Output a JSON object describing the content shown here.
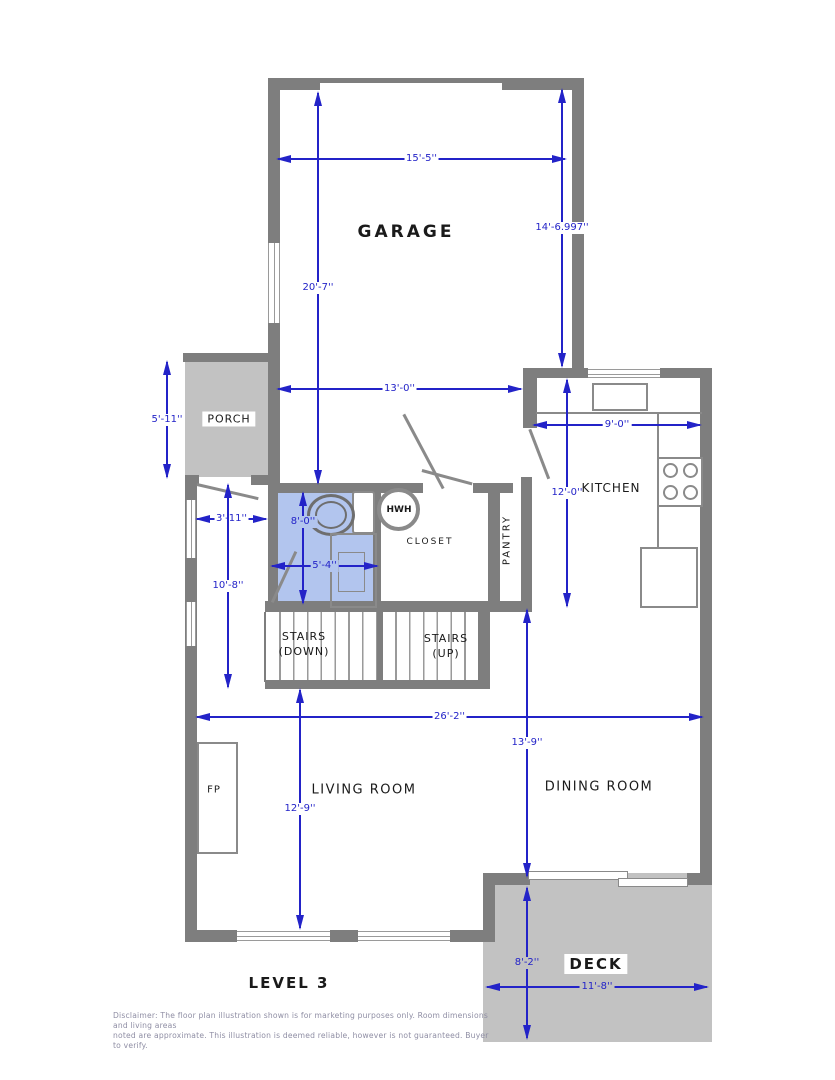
{
  "title": "Level 3 floor plan",
  "level_label": "LEVEL 3",
  "colors": {
    "wall": "#7e7e7e",
    "exterior_gray": "#c2c2c2",
    "bathroom_blue": "#b2c5ee",
    "dimension_blue": "#2323c8"
  },
  "rooms": {
    "garage": "GARAGE",
    "porch": "PORCH",
    "kitchen": "KITCHEN",
    "closet": "CLOSET",
    "pantry": "PANTRY",
    "living_room": "LIVING ROOM",
    "dining_room": "DINING ROOM",
    "deck": "DECK"
  },
  "fixtures": {
    "hwh": "HWH",
    "fireplace": "FP"
  },
  "stairs": {
    "down_line1": "STAIRS",
    "down_line2": "(DOWN)",
    "up_line1": "STAIRS",
    "up_line2": "(UP)"
  },
  "dimensions": {
    "garage_width": "15'-5''",
    "garage_depth": "20'-7''",
    "garage_right": "14'-6.997''",
    "garage_lower_width": "13'-0''",
    "porch_height": "5'-11''",
    "hall_width": "3'-11''",
    "hall_height": "10'-8''",
    "bath_height": "8'-0''",
    "bath_width": "5'-4''",
    "kitchen_width": "9'-0''",
    "kitchen_height": "12'-0''",
    "great_room_width": "26'-2''",
    "living_height": "12'-9''",
    "dining_height": "13'-9''",
    "deck_height": "8'-2''",
    "deck_width": "11'-8''"
  },
  "disclaimer": {
    "line1": "Disclaimer: The floor plan illustration shown is for marketing purposes only. Room dimensions and living areas",
    "line2": "noted are approximate. This illustration is deemed reliable, however is not guaranteed. Buyer to verify."
  }
}
